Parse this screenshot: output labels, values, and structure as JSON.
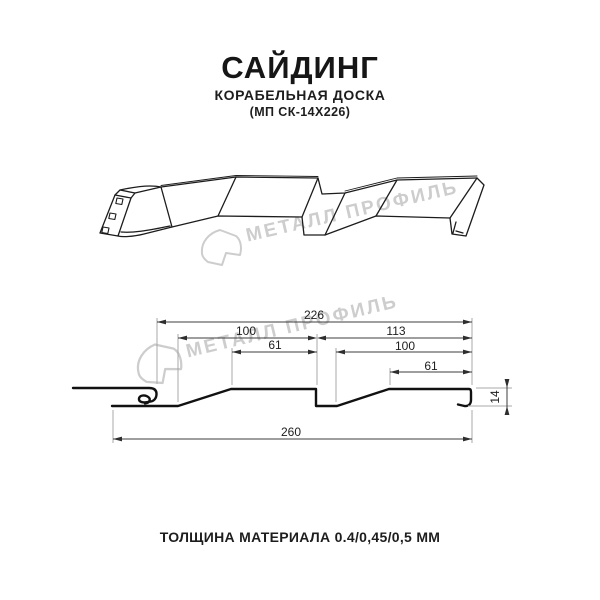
{
  "header": {
    "title": "САЙДИНГ",
    "subtitle": "КОРАБЕЛЬНАЯ ДОСКА",
    "model_code": "(МП СК-14Х226)"
  },
  "watermark": {
    "brand_text": "МЕТАЛЛ ПРОФИЛЬ"
  },
  "dims": {
    "overall": "226",
    "left_lower": "100",
    "left_upper": "61",
    "right_overall": "113",
    "right_lower": "100",
    "right_upper": "61",
    "height": "14",
    "total": "260"
  },
  "footer": {
    "thickness_note": "ТОЛЩИНА МАТЕРИАЛА 0.4/0,45/0,5 ММ"
  },
  "colors": {
    "profile_line": "#1c1c1c",
    "dimension_line": "#3c3c3c",
    "extension_line": "#a8a8a8",
    "watermark": "#cdcdcd",
    "text": "#1a1a1a"
  }
}
